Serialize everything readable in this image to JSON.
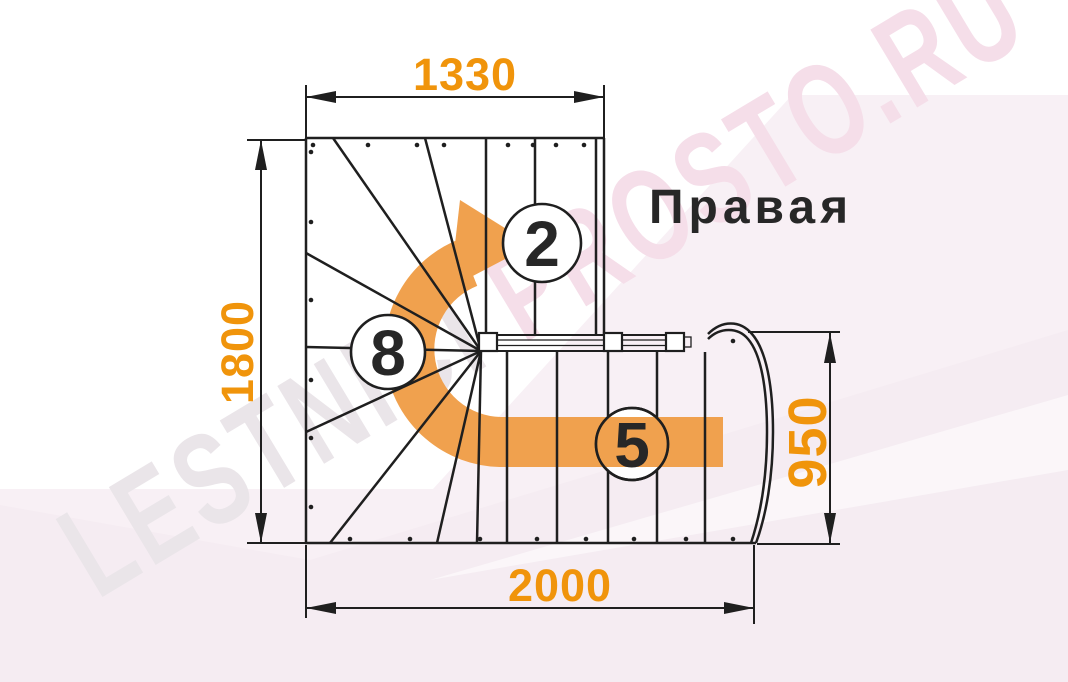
{
  "title": {
    "orientation_label": "Правая"
  },
  "dimensions": {
    "top_width": "1330",
    "left_height": "1800",
    "bottom_length": "2000",
    "entry_width": "950"
  },
  "step_labels": {
    "upper_flight": "2",
    "winder": "8",
    "lower_flight": "5"
  },
  "watermark": {
    "left_part": "LESTNICI ",
    "right_part": "PROSTO.RU"
  },
  "colors": {
    "dimension": "#F0940B",
    "arrow": "#F0A14E",
    "line": "#1F1F1F",
    "label": "#272727",
    "bg_pink": "#F8F0F5",
    "bg_pink2": "#F3E9F0",
    "watermark_gray": "#EAE5E9",
    "watermark_pink": "#F5DEE9"
  }
}
